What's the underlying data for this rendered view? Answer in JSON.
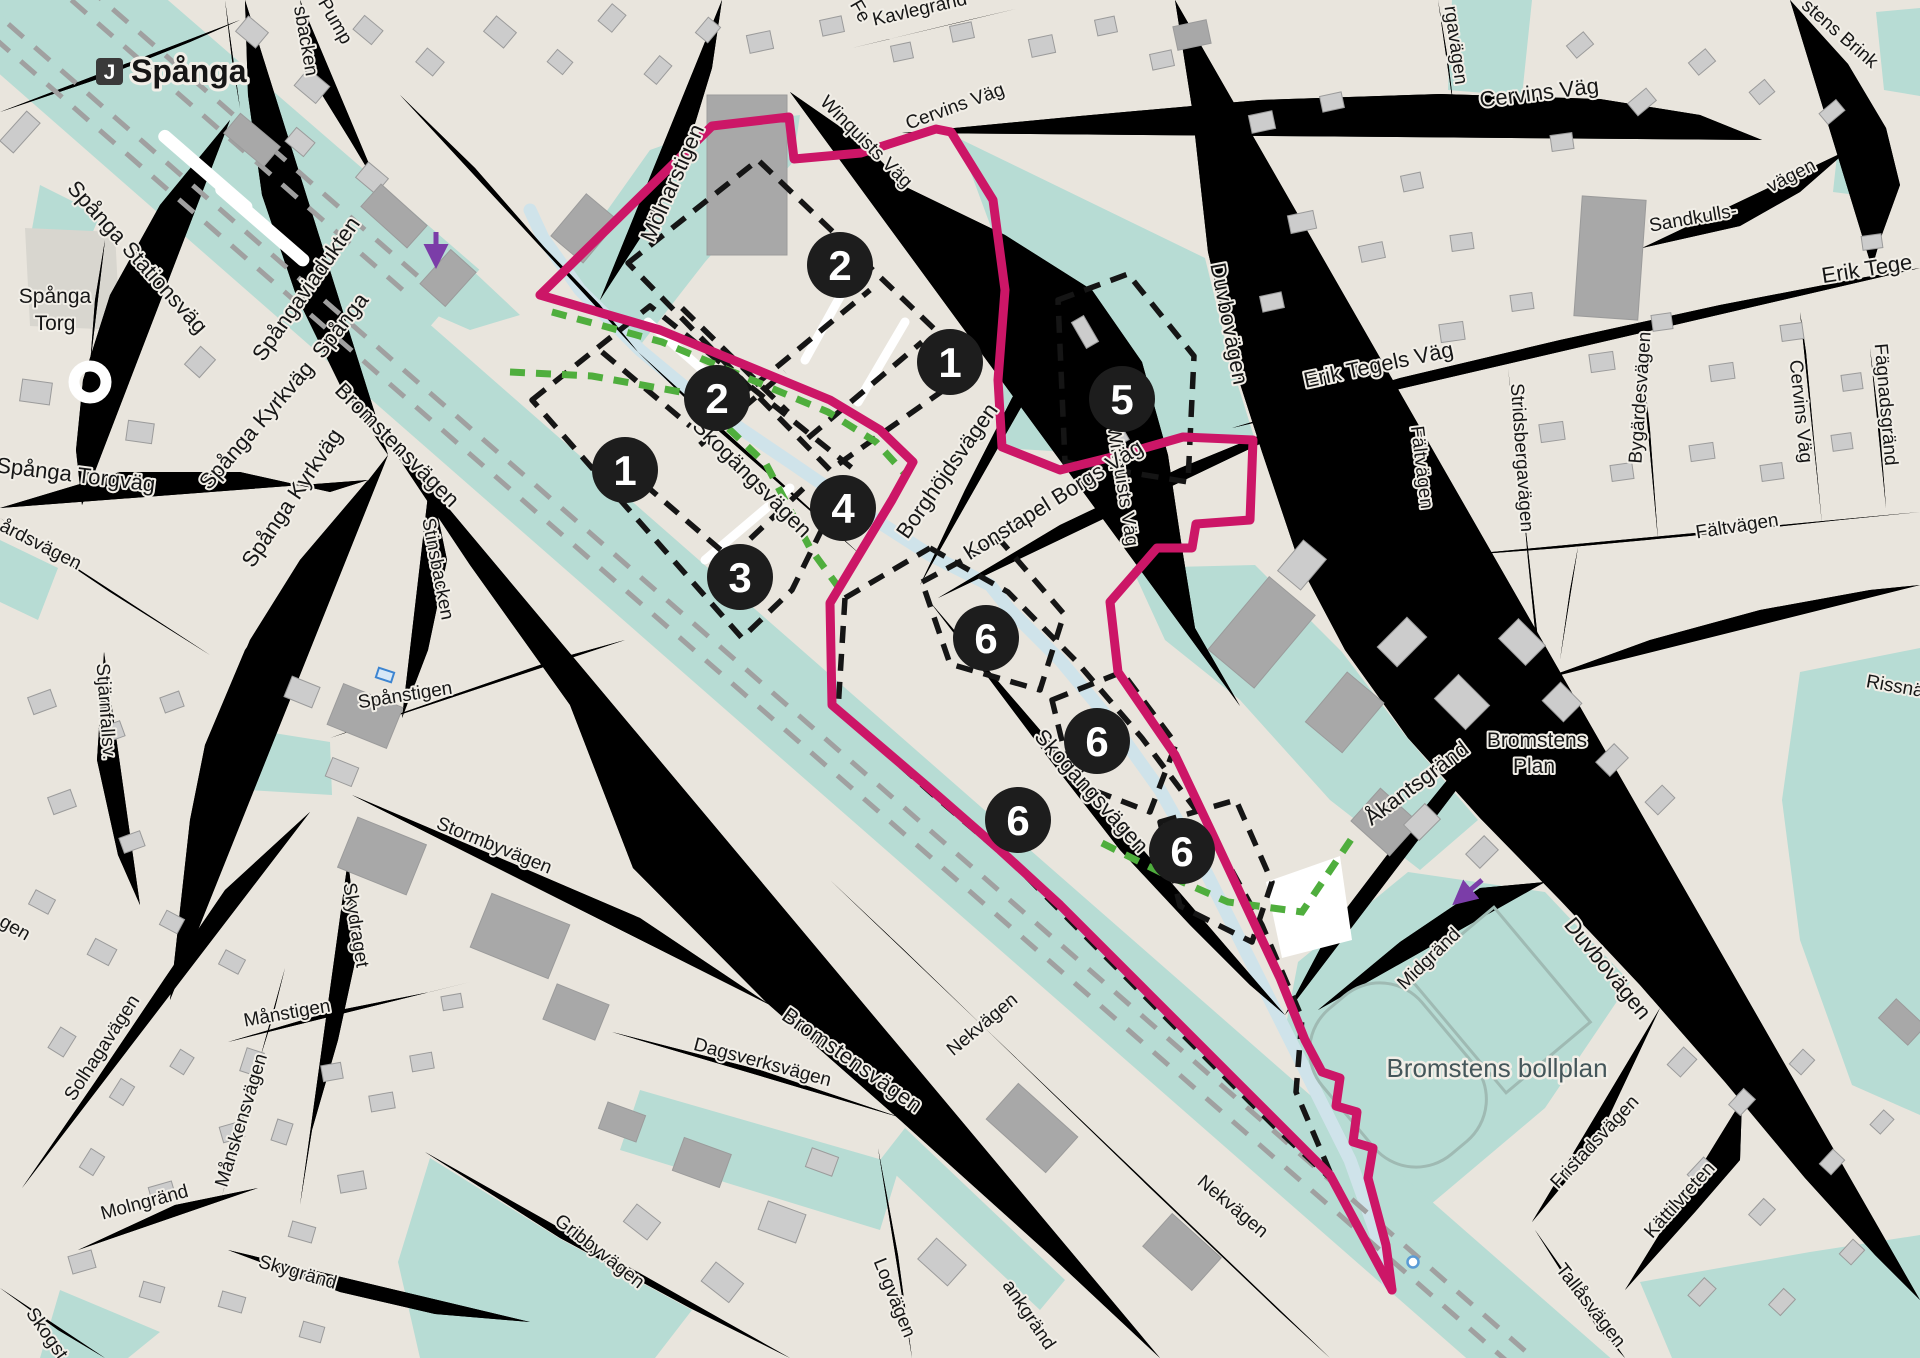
{
  "station": {
    "badge": "J",
    "name": "Spånga"
  },
  "markers": [
    {
      "n": "2"
    },
    {
      "n": "1"
    },
    {
      "n": "5"
    },
    {
      "n": "2"
    },
    {
      "n": "1"
    },
    {
      "n": "4"
    },
    {
      "n": "3"
    },
    {
      "n": "6"
    },
    {
      "n": "6"
    },
    {
      "n": "6"
    },
    {
      "n": "6"
    }
  ],
  "labels": [
    {
      "t": "Spånga Stationsväg"
    },
    {
      "t": "Spånga"
    },
    {
      "t": "Torg"
    },
    {
      "t": "Spånga Torgväg"
    },
    {
      "t": "årdsvägen"
    },
    {
      "t": "Spånga Kyrkväg"
    },
    {
      "t": "Spånga Kyrkväg"
    },
    {
      "t": "Spånga"
    },
    {
      "t": "Spångaviadukten"
    },
    {
      "t": "Bromstensvägen"
    },
    {
      "t": "Bromstensvägen"
    },
    {
      "t": "Stinsbacken"
    },
    {
      "t": "sbacken"
    },
    {
      "t": "Pump"
    },
    {
      "t": "Mölnarstigen"
    },
    {
      "t": "Winquists Väg"
    },
    {
      "t": "Winquists Väg"
    },
    {
      "t": "Cervins Väg"
    },
    {
      "t": "Cervins Väg"
    },
    {
      "t": "Cervins Väg"
    },
    {
      "t": "Kavlegränd"
    },
    {
      "t": "Fe"
    },
    {
      "t": "Duvbovägen"
    },
    {
      "t": "Duvbovägen"
    },
    {
      "t": "Erik Tegels Väg"
    },
    {
      "t": "Erik Tege"
    },
    {
      "t": "Sandkulls-"
    },
    {
      "t": "vägen"
    },
    {
      "t": "stens Brink"
    },
    {
      "t": "Stridsbergavägen"
    },
    {
      "t": "Bygärdesvägen"
    },
    {
      "t": "Fägnadsgränd"
    },
    {
      "t": "Fältvägen"
    },
    {
      "t": "Fältvägen"
    },
    {
      "t": "Rissnä"
    },
    {
      "t": "Konstapel Borgs Väg"
    },
    {
      "t": "Borghöjdsvägen"
    },
    {
      "t": "Skogängsvägen"
    },
    {
      "t": "Skogängsvägen"
    },
    {
      "t": "Åkantsgränd"
    },
    {
      "t": "Bromstens"
    },
    {
      "t": "Plan"
    },
    {
      "t": "Midgränd"
    },
    {
      "t": "Bromstens bollplan"
    },
    {
      "t": "Fristadsvägen"
    },
    {
      "t": "Kättilvreten"
    },
    {
      "t": "Tallåsvägen"
    },
    {
      "t": "Nekvägen"
    },
    {
      "t": "Nekvägen"
    },
    {
      "t": "ankgränd"
    },
    {
      "t": "Logvägen"
    },
    {
      "t": "Dagsverksvägen"
    },
    {
      "t": "Gribbyvägen"
    },
    {
      "t": "Stormbyvägen"
    },
    {
      "t": "Spånstigen"
    },
    {
      "t": "Skydraget"
    },
    {
      "t": "Stjärnfallsv."
    },
    {
      "t": "Månstigen"
    },
    {
      "t": "Månskensvägen"
    },
    {
      "t": "Solhagavägen"
    },
    {
      "t": "Molngränd"
    },
    {
      "t": "Skygränd"
    },
    {
      "t": "Skogst"
    },
    {
      "t": "gen"
    },
    {
      "t": "rgavägen"
    }
  ],
  "colors": {
    "boundary": "#cc1667",
    "block_dash": "#151515",
    "green_dash": "#4fae3d",
    "arrow": "#7b3da8",
    "green_area": "#b7dcd4",
    "water": "#cfe3ea",
    "marker_bg": "#1d1d1d",
    "background": "#e9e5dd"
  }
}
